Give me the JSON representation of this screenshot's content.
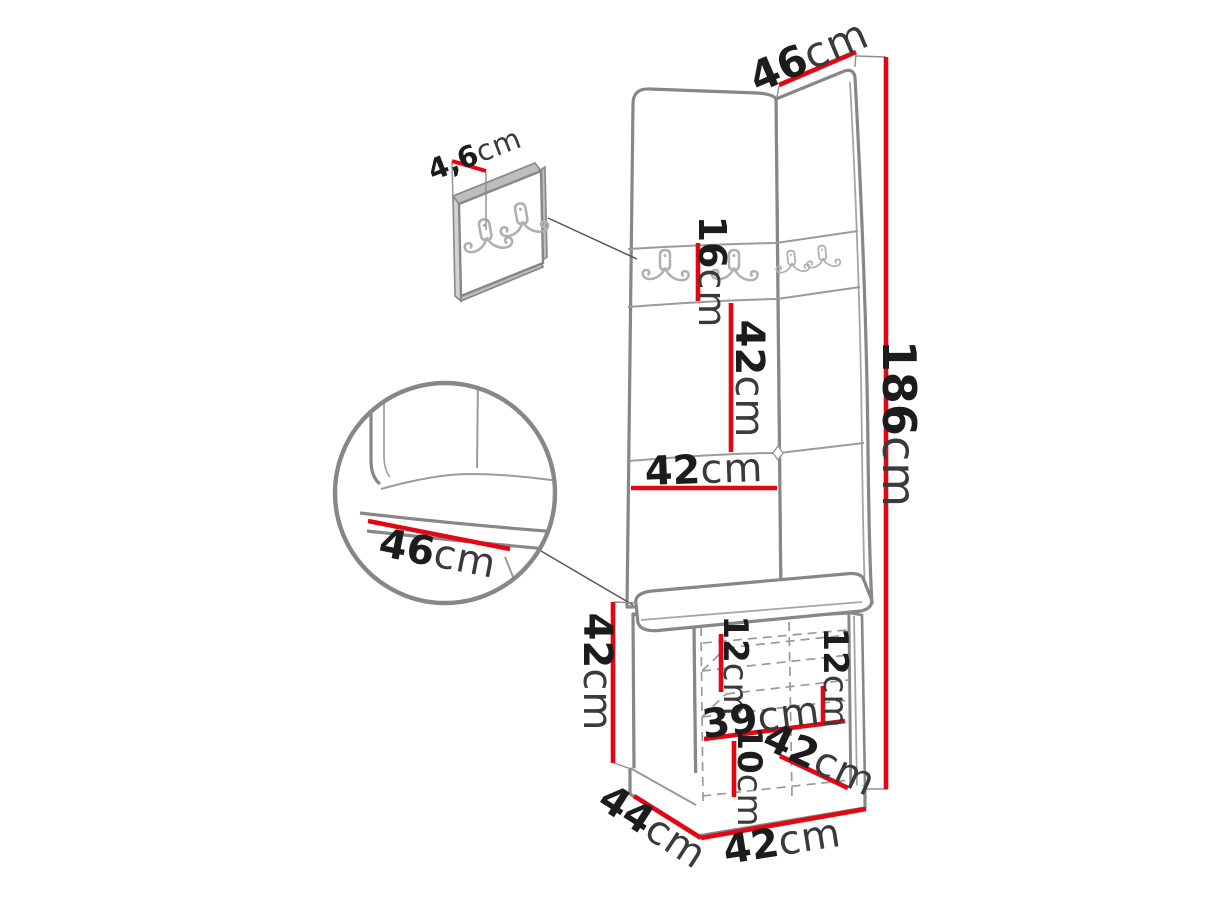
{
  "diagram": {
    "type": "furniture-dimension-diagram",
    "subject": "corner hallway panel set with hook boards and bench cabinet",
    "icons": {
      "hook_icon": "double-coat-hook",
      "detail_circle": "zoom-detail-circle"
    },
    "colors": {
      "dimension_line": "#e30613",
      "outline": "#878787",
      "text": "#1c1c1c"
    }
  },
  "dimensions": {
    "right_panel_width": {
      "value": "46",
      "unit": "cm"
    },
    "hook_board_thickness": {
      "value": "4,6",
      "unit": "cm"
    },
    "hook_strip_height": {
      "value": "16",
      "unit": "cm"
    },
    "middle_panel_height": {
      "value": "42",
      "unit": "cm"
    },
    "total_height": {
      "value": "186",
      "unit": "cm"
    },
    "left_panel_width": {
      "value": "42",
      "unit": "cm"
    },
    "seat_detail_depth": {
      "value": "46",
      "unit": "cm"
    },
    "bench_height": {
      "value": "42",
      "unit": "cm"
    },
    "upper_compartment_left": {
      "value": "12",
      "unit": "cm"
    },
    "upper_compartment_right": {
      "value": "12",
      "unit": "cm"
    },
    "inner_width": {
      "value": "39",
      "unit": "cm"
    },
    "lower_compartment": {
      "value": "10",
      "unit": "cm"
    },
    "door_diagonal": {
      "value": "42",
      "unit": "cm"
    },
    "bench_depth": {
      "value": "44",
      "unit": "cm"
    },
    "bench_width": {
      "value": "42",
      "unit": "cm"
    }
  }
}
